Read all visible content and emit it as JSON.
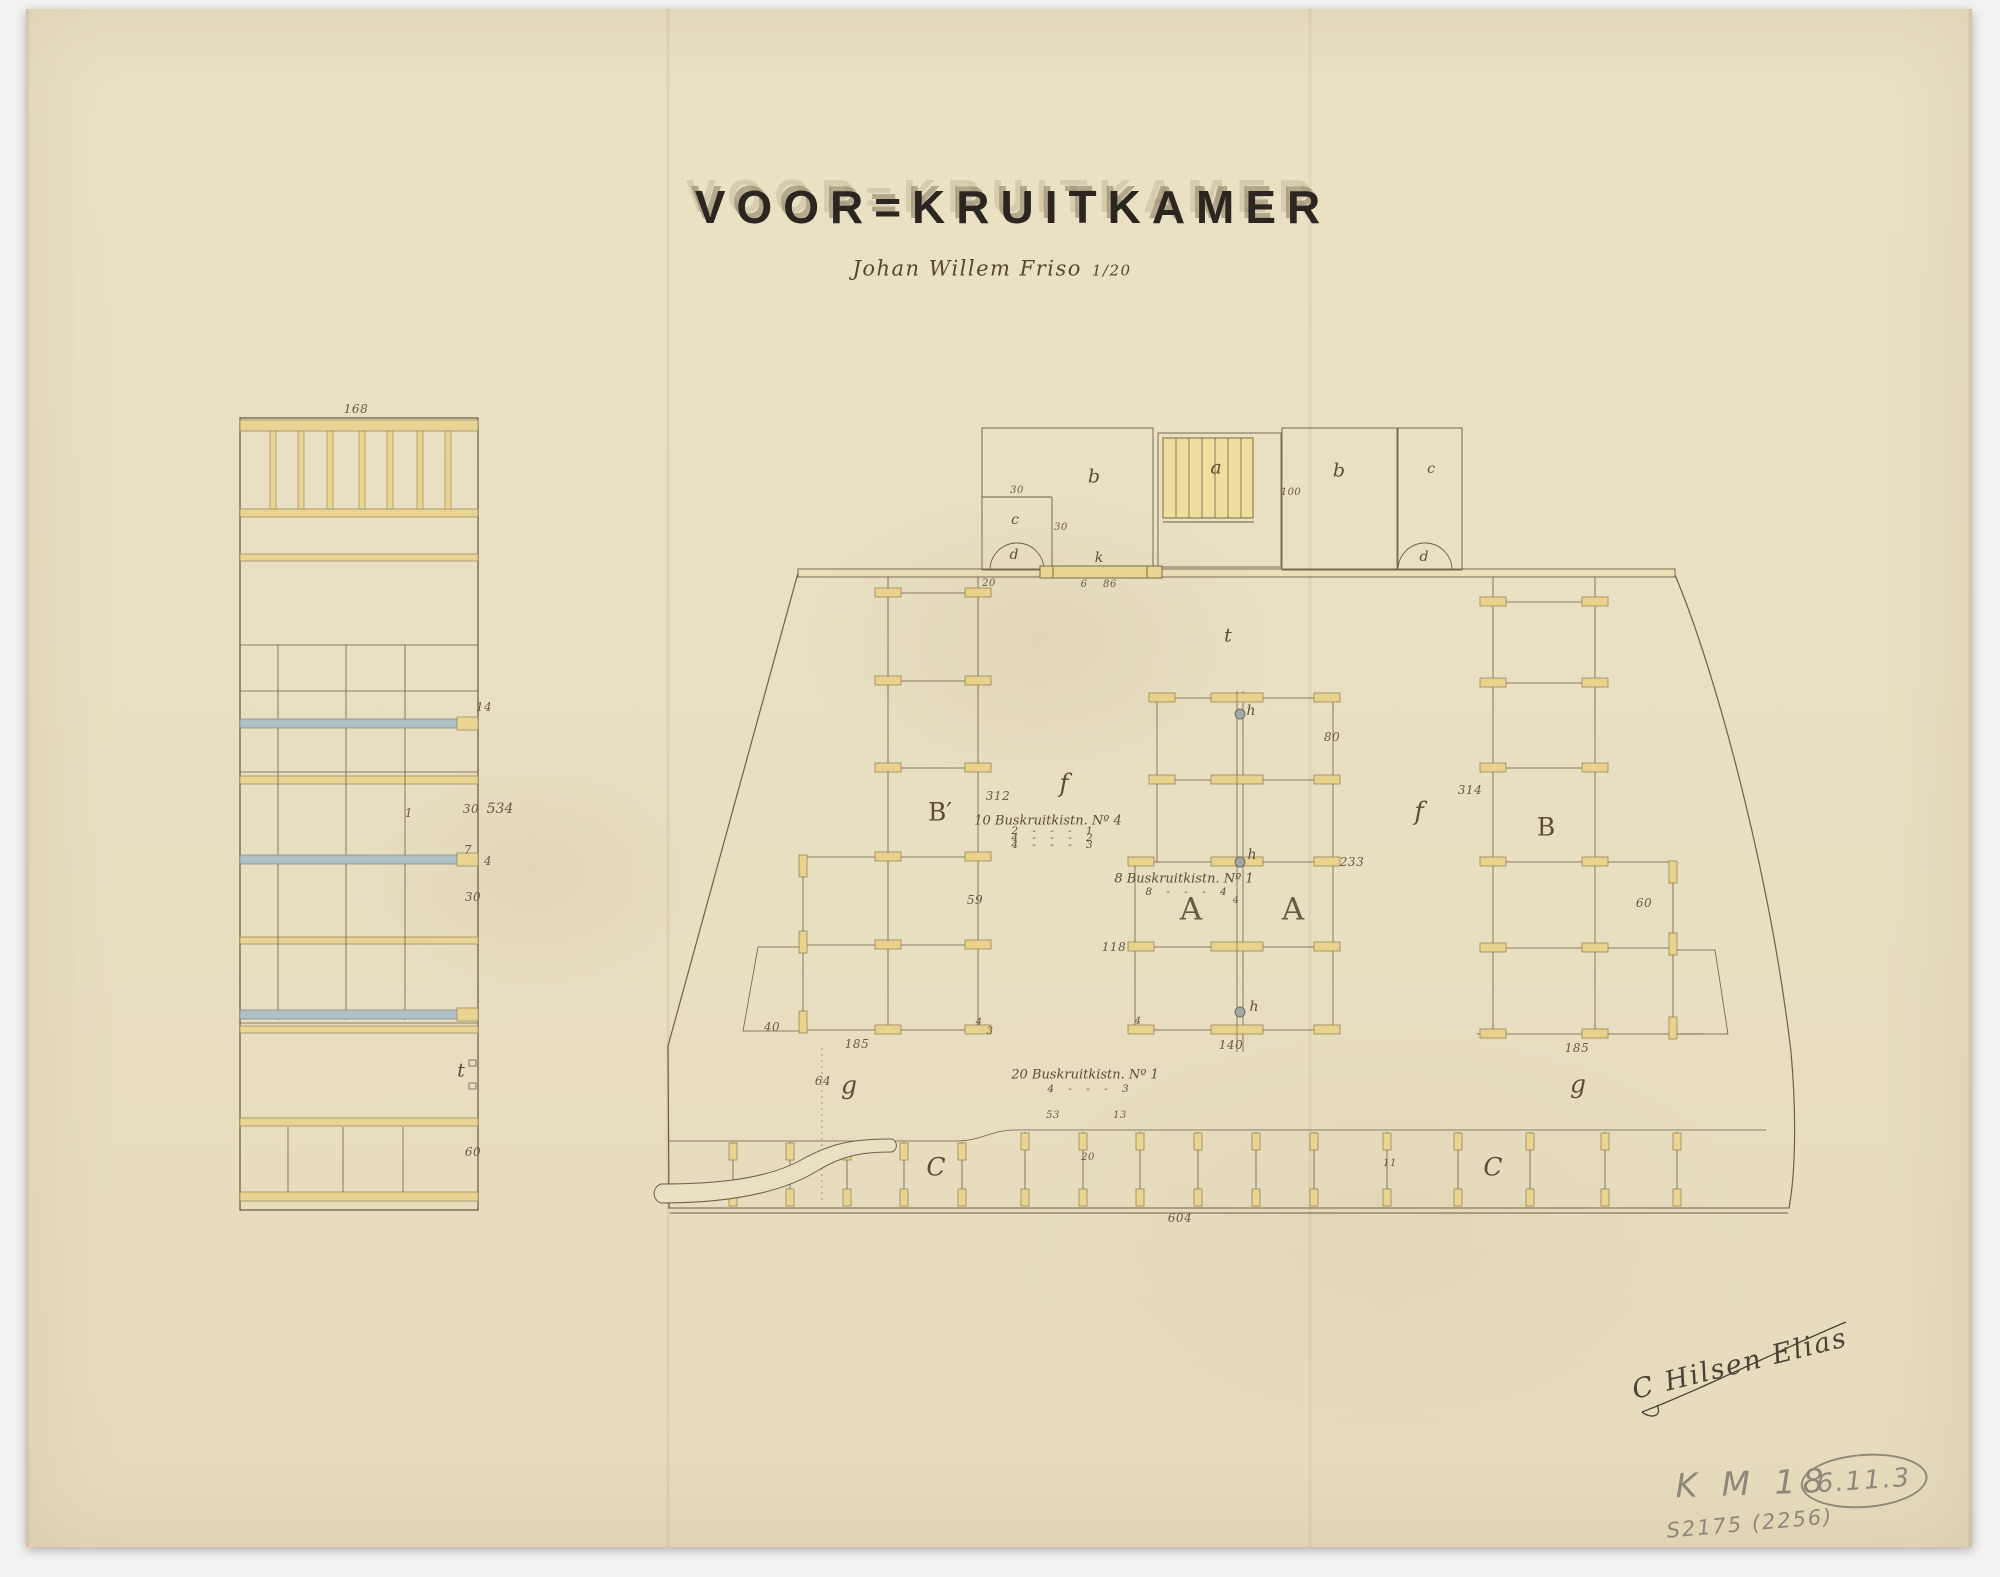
{
  "labels": {
    "title": "VOOR=KRUITKAMER",
    "subtitle_name": "Johan Willem Friso",
    "subtitle_scale": "1/20",
    "le_top": "168",
    "le_14": "14",
    "le_1": "1",
    "le_30a": "30",
    "le_534": "534",
    "le_7": "7",
    "le_4": "4",
    "le_30b": "30",
    "le_t": "t",
    "le_60": "60",
    "room_b_left": "b",
    "room_c_inner": "c",
    "room_d_left": "d",
    "dim_30_a": "30",
    "dim_30_b": "30",
    "dim_20_left": "20",
    "room_a": "a",
    "dim_100": "100",
    "room_b_right": "b",
    "room_c_right": "c",
    "room_d_right": "d",
    "hatch_k": "k",
    "dim_6": "6",
    "dim_86": "86",
    "deck_t": "t",
    "rack_b_prime": "B′",
    "dim_312": "312",
    "dim_59": "59",
    "f_left": "f",
    "f_right": "f",
    "rack_b": "B",
    "dim_314": "314",
    "dim_60_right": "60",
    "h_1": "h",
    "h_2": "h",
    "h_3": "h",
    "a_1": "A",
    "a_2": "A",
    "dim_80": "80",
    "dim_233": "233",
    "dim_118": "118",
    "dim_140": "140",
    "dim_4_center": "4",
    "dim_4_left": "4",
    "dim_4_corner": "4",
    "dim_3_corner": "3",
    "dim_40": "40",
    "dim_185_left": "185",
    "dim_185_right": "185",
    "note1_l1": "10 Buskruitkistn. Nº 4",
    "note1_l2": "2 - - - 1",
    "note1_l3": "4 - - - 2",
    "note1_l4": "4 - - - 3",
    "note2_l1": "8 Buskruitkistn. Nº 1",
    "note2_l2": "8 - - - 4",
    "note3_l1": "20 Buskruitkistn. Nº 1",
    "note3_l2": "4 - - - 3",
    "dim_64": "64",
    "g_left": "g",
    "g_right": "g",
    "c_hold_left": "C",
    "c_hold_right": "C",
    "dim_53": "53",
    "dim_13": "13",
    "dim_20_band": "20",
    "dim_11": "11",
    "dim_604": "604",
    "signature": "C Hilsen Elias",
    "pencil_km": "K M 18",
    "pencil_circle": "6.11.3",
    "pencil_catalog": "S2175 (2256)"
  },
  "colors": {
    "paper": "#e9dfc2",
    "ink": "#6e5f45",
    "wood_yellow": "#e9d591",
    "shelf_blue": "#b0c1c6",
    "title_ink": "#2b261f",
    "pencil_gray": "#8e887a"
  }
}
